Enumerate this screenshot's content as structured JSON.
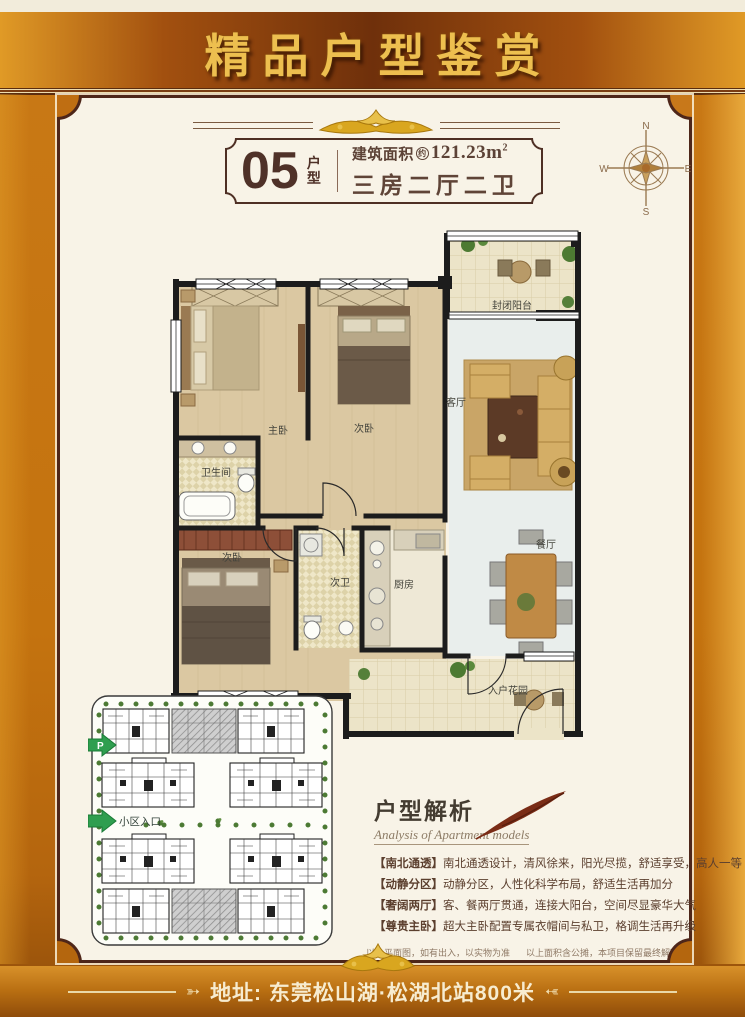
{
  "banner": {
    "title": "精品户型鉴赏"
  },
  "unit": {
    "number": "05",
    "type_chars": [
      "户",
      "型"
    ],
    "area_label": "建筑面积",
    "area_approx": "约",
    "area_value": "121.23m",
    "area_exp": "2",
    "rooms_summary": "三房二厅二卫"
  },
  "compass": {
    "n": "N",
    "e": "E",
    "s": "S",
    "w": "W"
  },
  "floorplan": {
    "rooms": [
      {
        "label": "封闭阳台"
      },
      {
        "label": "客厅"
      },
      {
        "label": "主卧"
      },
      {
        "label": "次卧"
      },
      {
        "label": "卫生间"
      },
      {
        "label": "次卧"
      },
      {
        "label": "次卫"
      },
      {
        "label": "厨房"
      },
      {
        "label": "餐厅"
      },
      {
        "label": "入户花园"
      }
    ]
  },
  "siteplan": {
    "parking_label": "P",
    "entrance_label": "小区入口"
  },
  "analysis": {
    "title": "户型解析",
    "subtitle": "Analysis of Apartment models",
    "items": [
      {
        "tag": "【南北通透】",
        "text": "南北通透设计，清风徐来，阳光尽揽，舒适享受，高人一等"
      },
      {
        "tag": "【动静分区】",
        "text": "动静分区，人性化科学布局，舒适生活再加分"
      },
      {
        "tag": "【奢阔两厅】",
        "text": "客、餐两厅贯通，连接大阳台，空间尽显豪华大气"
      },
      {
        "tag": "【尊贵主卧】",
        "text": "超大主卧配置专属衣帽间与私卫，格调生活再升级"
      }
    ]
  },
  "footnotes": {
    "disclaimer_left": "以上平面图，如有出入，以实物为准",
    "disclaimer_right": "以上面积含公摊，本项目保留最终解释权"
  },
  "address": {
    "label": "地址: 东莞松山湖·松湖北站800米"
  },
  "colors": {
    "gold": "#d9a61f",
    "deep_brown": "#4e2619",
    "orange_background": "#c4730f",
    "panel_cream": "#f8f3e7",
    "text_brown": "#5b3f2e",
    "entrance_arrow_green": "#2f9e4f"
  }
}
